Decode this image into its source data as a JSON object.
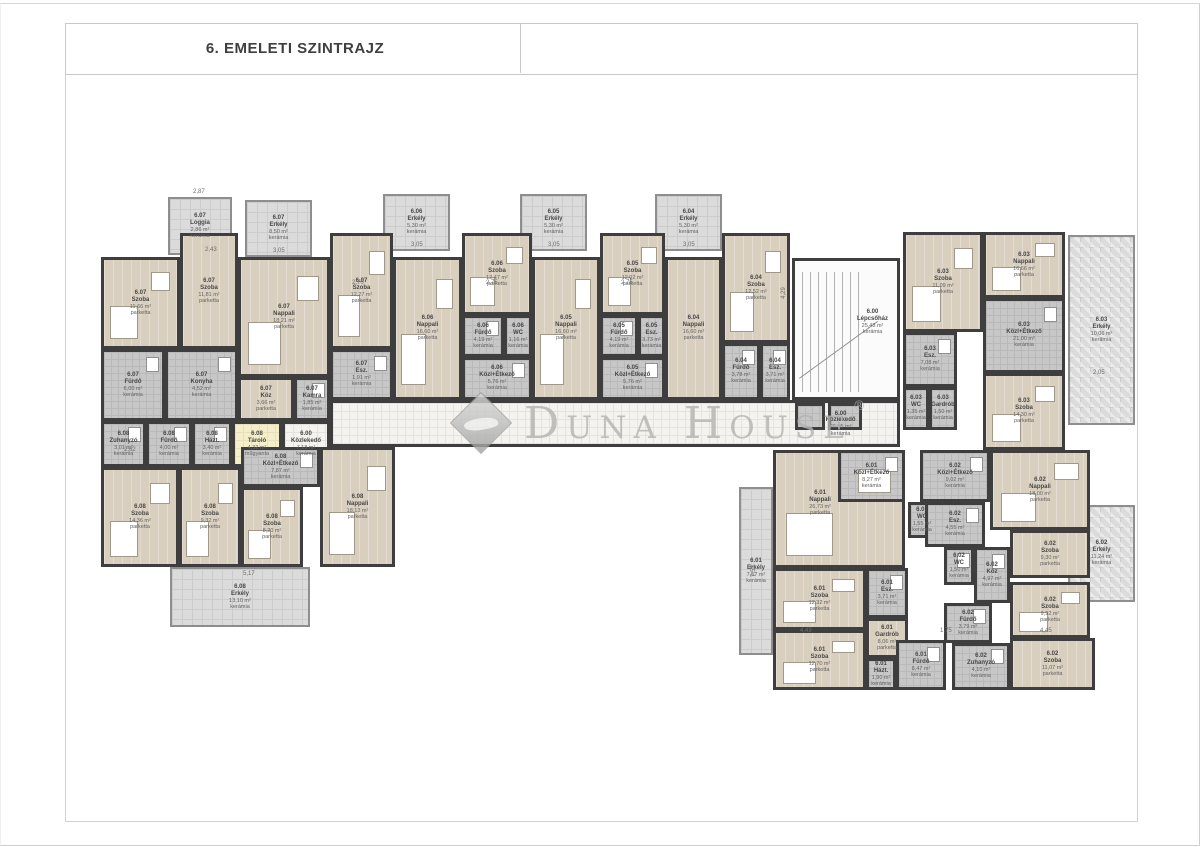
{
  "page": {
    "title": "6. EMELETI SZINTRAJZ"
  },
  "watermark": {
    "text": "Duna House",
    "reg": "®"
  },
  "colors": {
    "wall": "#3e3e3e",
    "parquet_room": "#d9cfbf",
    "ceramic_room": "#c7c7c7",
    "corridor": "#f4f3ef",
    "storage": "#f4eecb",
    "balcony": "#dbdbdb",
    "watermark_gray": "#b3b3b3"
  },
  "legend": {
    "room_types": [
      "parketta = parquet floor",
      "kerámia = ceramic tile",
      "műgyanta = resin floor"
    ],
    "floor_label": "6. emelet"
  },
  "plan": {
    "rooms": [
      {
        "u": "6.07",
        "n": "Loggia",
        "a": "2,86 m²",
        "f": "kerámia",
        "t": "balc",
        "x": 168,
        "y": 197,
        "w": 64,
        "h": 58
      },
      {
        "u": "6.07",
        "n": "Erkély",
        "a": "8,50 m²",
        "f": "kerámia",
        "t": "balc",
        "x": 245,
        "y": 200,
        "w": 67,
        "h": 57
      },
      {
        "u": "6.06",
        "n": "Erkély",
        "a": "5,30 m²",
        "f": "kerámia",
        "t": "balc",
        "x": 383,
        "y": 194,
        "w": 67,
        "h": 57
      },
      {
        "u": "6.05",
        "n": "Erkély",
        "a": "5,30 m²",
        "f": "kerámia",
        "t": "balc",
        "x": 520,
        "y": 194,
        "w": 67,
        "h": 57
      },
      {
        "u": "6.04",
        "n": "Erkély",
        "a": "5,30 m²",
        "f": "kerámia",
        "t": "balc",
        "x": 655,
        "y": 194,
        "w": 67,
        "h": 57
      },
      {
        "u": "6.03",
        "n": "Erkély",
        "a": "10,06 m²",
        "f": "kerámia",
        "t": "balch",
        "x": 1068,
        "y": 235,
        "w": 67,
        "h": 190
      },
      {
        "u": "6.02",
        "n": "Erkély",
        "a": "11,24 m²",
        "f": "kerámia",
        "t": "balch",
        "x": 1068,
        "y": 505,
        "w": 67,
        "h": 97
      },
      {
        "u": "6.01",
        "n": "Erkély",
        "a": "7,57 m²",
        "f": "kerámia",
        "t": "balc",
        "x": 739,
        "y": 487,
        "w": 34,
        "h": 168
      },
      {
        "u": "6.08",
        "n": "Erkély",
        "a": "13,10 m²",
        "f": "kerámia",
        "t": "balc",
        "x": 170,
        "y": 567,
        "w": 140,
        "h": 60
      },
      {
        "u": "6.07",
        "n": "Szoba",
        "a": "11,66 m²",
        "f": "parketta",
        "t": "park",
        "x": 101,
        "y": 257,
        "w": 79,
        "h": 92
      },
      {
        "u": "6.07",
        "n": "Fürdő",
        "a": "6,00 m²",
        "f": "kerámia",
        "t": "tile",
        "x": 101,
        "y": 349,
        "w": 64,
        "h": 72
      },
      {
        "u": "6.07",
        "n": "Szoba",
        "a": "11,81 m²",
        "f": "parketta",
        "t": "park",
        "x": 180,
        "y": 233,
        "w": 58,
        "h": 116
      },
      {
        "u": "6.07",
        "n": "Konyha",
        "a": "4,52 m²",
        "f": "kerámia",
        "t": "tile",
        "x": 165,
        "y": 349,
        "w": 73,
        "h": 72
      },
      {
        "u": "6.07",
        "n": "Nappali",
        "a": "18,21 m²",
        "f": "parketta",
        "t": "park",
        "x": 238,
        "y": 257,
        "w": 92,
        "h": 120
      },
      {
        "u": "6.07",
        "n": "Köz",
        "a": "3,66 m²",
        "f": "parketta",
        "t": "park",
        "x": 238,
        "y": 377,
        "w": 56,
        "h": 44
      },
      {
        "u": "6.07",
        "n": "Kamra",
        "a": "1,85 m²",
        "f": "kerámia",
        "t": "tile",
        "x": 294,
        "y": 377,
        "w": 36,
        "h": 44
      },
      {
        "u": "6.07",
        "n": "Szoba",
        "a": "12,27 m²",
        "f": "parketta",
        "t": "park",
        "x": 330,
        "y": 233,
        "w": 63,
        "h": 116
      },
      {
        "u": "6.07",
        "n": "Esz.",
        "a": "1,91 m²",
        "f": "kerámia",
        "t": "tile",
        "x": 330,
        "y": 349,
        "w": 63,
        "h": 51
      },
      {
        "u": "6.06",
        "n": "Nappali",
        "a": "16,60 m²",
        "f": "parketta",
        "t": "park",
        "x": 393,
        "y": 257,
        "w": 69,
        "h": 143
      },
      {
        "u": "6.06",
        "n": "Szoba",
        "a": "12,47 m²",
        "f": "parketta",
        "t": "park",
        "x": 462,
        "y": 233,
        "w": 70,
        "h": 82
      },
      {
        "u": "6.06",
        "n": "Fürdő",
        "a": "4,19 m²",
        "f": "kerámia",
        "t": "tile",
        "x": 462,
        "y": 315,
        "w": 42,
        "h": 42
      },
      {
        "u": "6.06",
        "n": "WC",
        "a": "1,16 m²",
        "f": "kerámia",
        "t": "tile",
        "x": 504,
        "y": 315,
        "w": 28,
        "h": 42
      },
      {
        "u": "6.06",
        "n": "Közl+Étkező",
        "a": "5,76 m²",
        "f": "kerámia",
        "t": "tile",
        "x": 462,
        "y": 357,
        "w": 70,
        "h": 43
      },
      {
        "u": "6.05",
        "n": "Nappali",
        "a": "16,60 m²",
        "f": "parketta",
        "t": "park",
        "x": 532,
        "y": 257,
        "w": 68,
        "h": 143
      },
      {
        "u": "6.05",
        "n": "Szoba",
        "a": "12,02 m²",
        "f": "parketta",
        "t": "park",
        "x": 600,
        "y": 233,
        "w": 65,
        "h": 82
      },
      {
        "u": "6.05",
        "n": "Fürdő",
        "a": "4,19 m²",
        "f": "kerámia",
        "t": "tile",
        "x": 600,
        "y": 315,
        "w": 38,
        "h": 42
      },
      {
        "u": "6.05",
        "n": "Esz.",
        "a": "3,73 m²",
        "f": "kerámia",
        "t": "tile",
        "x": 638,
        "y": 315,
        "w": 27,
        "h": 42
      },
      {
        "u": "6.05",
        "n": "Közl+Étkező",
        "a": "5,76 m²",
        "f": "kerámia",
        "t": "tile",
        "x": 600,
        "y": 357,
        "w": 65,
        "h": 43
      },
      {
        "u": "6.04",
        "n": "Nappali",
        "a": "16,60 m²",
        "f": "parketta",
        "t": "park",
        "x": 665,
        "y": 257,
        "w": 57,
        "h": 143
      },
      {
        "u": "6.04",
        "n": "Szoba",
        "a": "12,52 m²",
        "f": "parketta",
        "t": "park",
        "x": 722,
        "y": 233,
        "w": 68,
        "h": 110
      },
      {
        "u": "6.04",
        "n": "Fürdő",
        "a": "3,78 m²",
        "f": "kerámia",
        "t": "tile",
        "x": 722,
        "y": 343,
        "w": 38,
        "h": 57
      },
      {
        "u": "6.04",
        "n": "Esz.",
        "a": "3,71 m²",
        "f": "kerámia",
        "t": "tile",
        "x": 760,
        "y": 343,
        "w": 30,
        "h": 57
      },
      {
        "u": "6.00",
        "n": "Lépcsőház",
        "a": "25,43 m²",
        "f": "kerámia",
        "t": "stair",
        "x": 792,
        "y": 258,
        "w": 108,
        "h": 142,
        "cx": 76,
        "cy": 45
      },
      {
        "u": "6.00",
        "n": "Közlekedő",
        "a": "26,55 m²",
        "f": "kerámia",
        "t": "corr",
        "x": 330,
        "y": 400,
        "w": 570,
        "h": 47,
        "cx": 90,
        "cy": 50
      },
      {
        "t": "tile",
        "x": 795,
        "y": 403,
        "w": 30,
        "h": 27
      },
      {
        "t": "tile",
        "x": 828,
        "y": 403,
        "w": 34,
        "h": 27
      },
      {
        "u": "6.00",
        "n": "Közlekedő",
        "a": "7,18 m²",
        "f": "kerámia",
        "t": "corr",
        "x": 282,
        "y": 421,
        "w": 48,
        "h": 46
      },
      {
        "u": "6.08",
        "n": "Zuhanyzó",
        "a": "3,01 m²",
        "f": "kerámia",
        "t": "tile",
        "x": 101,
        "y": 421,
        "w": 45,
        "h": 46
      },
      {
        "u": "6.08",
        "n": "Fürdő",
        "a": "4,00 m²",
        "f": "kerámia",
        "t": "tile",
        "x": 146,
        "y": 421,
        "w": 46,
        "h": 46
      },
      {
        "u": "6.08",
        "n": "Házt.",
        "a": "3,40 m²",
        "f": "kerámia",
        "t": "tile",
        "x": 192,
        "y": 421,
        "w": 40,
        "h": 46
      },
      {
        "u": "6.08",
        "n": "Tároló",
        "a": "4,32 m²",
        "f": "műgyanta",
        "t": "stor",
        "x": 232,
        "y": 421,
        "w": 50,
        "h": 46
      },
      {
        "u": "6.08",
        "n": "Szoba",
        "a": "14,36 m²",
        "f": "parketta",
        "t": "park",
        "x": 101,
        "y": 467,
        "w": 78,
        "h": 100
      },
      {
        "u": "6.08",
        "n": "Szoba",
        "a": "9,32 m²",
        "f": "parketta",
        "t": "park",
        "x": 179,
        "y": 467,
        "w": 62,
        "h": 100
      },
      {
        "u": "6.08",
        "n": "Közl+Étkező",
        "a": "7,87 m²",
        "f": "kerámia",
        "t": "tile",
        "x": 241,
        "y": 447,
        "w": 79,
        "h": 40
      },
      {
        "u": "6.08",
        "n": "Szoba",
        "a": "8,20 m²",
        "f": "parketta",
        "t": "park",
        "x": 241,
        "y": 487,
        "w": 62,
        "h": 80
      },
      {
        "u": "6.08",
        "n": "Nappali",
        "a": "18,13 m²",
        "f": "parketta",
        "t": "park",
        "x": 320,
        "y": 447,
        "w": 75,
        "h": 120
      },
      {
        "u": "6.03",
        "n": "Szoba",
        "a": "11,09 m²",
        "f": "parketta",
        "t": "park",
        "x": 903,
        "y": 232,
        "w": 80,
        "h": 100
      },
      {
        "u": "6.03",
        "n": "Nappali",
        "a": "16,66 m²",
        "f": "parketta",
        "t": "park",
        "x": 983,
        "y": 232,
        "w": 82,
        "h": 66
      },
      {
        "u": "6.03",
        "n": "Közl+Étkező",
        "a": "21,00 m²",
        "f": "kerámia",
        "t": "tile",
        "x": 983,
        "y": 298,
        "w": 82,
        "h": 75
      },
      {
        "u": "6.03",
        "n": "Esz.",
        "a": "7,08 m²",
        "f": "kerámia",
        "t": "tile",
        "x": 903,
        "y": 332,
        "w": 54,
        "h": 55
      },
      {
        "u": "6.03",
        "n": "WC",
        "a": "1,35 m²",
        "f": "kerámia",
        "t": "tile",
        "x": 903,
        "y": 387,
        "w": 26,
        "h": 43
      },
      {
        "u": "6.03",
        "n": "Gardrób",
        "a": "1,50 m²",
        "f": "kerámia",
        "t": "tile",
        "x": 929,
        "y": 387,
        "w": 28,
        "h": 43
      },
      {
        "u": "6.03",
        "n": "Szoba",
        "a": "14,30 m²",
        "f": "parketta",
        "t": "park",
        "x": 983,
        "y": 373,
        "w": 82,
        "h": 77
      },
      {
        "u": "6.01",
        "n": "Nappali",
        "a": "26,73 m²",
        "f": "parketta",
        "t": "park",
        "x": 773,
        "y": 450,
        "w": 132,
        "h": 118,
        "cx": 35,
        "cy": 45
      },
      {
        "u": "6.01",
        "n": "Közl+Étkező",
        "a": "8,27 m²",
        "f": "kerámia",
        "t": "tile",
        "x": 838,
        "y": 450,
        "w": 67,
        "h": 52
      },
      {
        "u": "6.01",
        "n": "Esz.",
        "a": "3,71 m²",
        "f": "kerámia",
        "t": "tile",
        "x": 866,
        "y": 568,
        "w": 42,
        "h": 50
      },
      {
        "u": "6.01",
        "n": "Szoba",
        "a": "12,32 m²",
        "f": "parketta",
        "t": "park",
        "x": 773,
        "y": 568,
        "w": 93,
        "h": 62
      },
      {
        "u": "6.01",
        "n": "Szoba",
        "a": "12,70 m²",
        "f": "parketta",
        "t": "park",
        "x": 773,
        "y": 630,
        "w": 93,
        "h": 60
      },
      {
        "u": "6.01",
        "n": "Gardrób",
        "a": "8,06 m²",
        "f": "parketta",
        "t": "park",
        "x": 866,
        "y": 618,
        "w": 42,
        "h": 40
      },
      {
        "u": "6.01",
        "n": "Házt.",
        "a": "1,90 m²",
        "f": "kerámia",
        "t": "tile",
        "x": 866,
        "y": 658,
        "w": 30,
        "h": 32
      },
      {
        "u": "6.01",
        "n": "Fürdő",
        "a": "8,47 m²",
        "f": "kerámia",
        "t": "tile",
        "x": 896,
        "y": 640,
        "w": 50,
        "h": 50
      },
      {
        "u": "6.01",
        "n": "WC",
        "a": "1,55 m²",
        "f": "kerámia",
        "t": "tile",
        "x": 908,
        "y": 502,
        "w": 28,
        "h": 36
      },
      {
        "u": "6.02",
        "n": "Közl+Étkező",
        "a": "9,02 m²",
        "f": "kerámia",
        "t": "tile",
        "x": 920,
        "y": 450,
        "w": 70,
        "h": 52
      },
      {
        "u": "6.02",
        "n": "Esz.",
        "a": "4,55 m²",
        "f": "kerámia",
        "t": "tile",
        "x": 925,
        "y": 502,
        "w": 60,
        "h": 45
      },
      {
        "u": "6.02",
        "n": "WC",
        "a": "1,50 m²",
        "f": "kerámia",
        "t": "tile",
        "x": 944,
        "y": 547,
        "w": 30,
        "h": 38
      },
      {
        "u": "6.02",
        "n": "Nappali",
        "a": "18,00 m²",
        "f": "parketta",
        "t": "park",
        "x": 990,
        "y": 450,
        "w": 100,
        "h": 80
      },
      {
        "u": "6.02",
        "n": "Köz",
        "a": "4,97 m²",
        "f": "kerámia",
        "t": "tile",
        "x": 974,
        "y": 547,
        "w": 36,
        "h": 56
      },
      {
        "u": "6.02",
        "n": "Szoba",
        "a": "9,30 m²",
        "f": "parketta",
        "t": "park",
        "x": 1010,
        "y": 530,
        "w": 80,
        "h": 48
      },
      {
        "u": "6.02",
        "n": "Szoba",
        "a": "9,92 m²",
        "f": "parketta",
        "t": "park",
        "x": 1010,
        "y": 582,
        "w": 80,
        "h": 56
      },
      {
        "u": "6.02",
        "n": "Fürdő",
        "a": "3,79 m²",
        "f": "kerámia",
        "t": "tile",
        "x": 944,
        "y": 603,
        "w": 48,
        "h": 40
      },
      {
        "u": "6.02",
        "n": "Zuhanyzó",
        "a": "4,10 m²",
        "f": "kerámia",
        "t": "tile",
        "x": 952,
        "y": 643,
        "w": 58,
        "h": 47
      },
      {
        "u": "6.02",
        "n": "Szoba",
        "a": "11,07 m²",
        "f": "parketta",
        "t": "park",
        "x": 1010,
        "y": 638,
        "w": 85,
        "h": 52
      }
    ],
    "dims": [
      {
        "t": "2,87",
        "x": 193,
        "y": 189
      },
      {
        "t": "2,43",
        "x": 205,
        "y": 247
      },
      {
        "t": "3,05",
        "x": 273,
        "y": 248
      },
      {
        "t": "3,05",
        "x": 411,
        "y": 242
      },
      {
        "t": "3,05",
        "x": 548,
        "y": 242
      },
      {
        "t": "3,05",
        "x": 683,
        "y": 242
      },
      {
        "t": "2,70",
        "x": 352,
        "y": 280
      },
      {
        "t": "2,75",
        "x": 486,
        "y": 280
      },
      {
        "t": "2,75",
        "x": 621,
        "y": 280
      },
      {
        "t": "2,62",
        "x": 124,
        "y": 447
      },
      {
        "t": "5,17",
        "x": 243,
        "y": 571
      },
      {
        "t": "2,05",
        "x": 1093,
        "y": 370
      },
      {
        "t": "4,45",
        "x": 1040,
        "y": 628
      },
      {
        "t": "4,43",
        "x": 800,
        "y": 628
      },
      {
        "t": "1,75",
        "x": 940,
        "y": 628
      },
      {
        "t": "7,57",
        "x": 748,
        "y": 568,
        "r": 1
      },
      {
        "t": "4,29",
        "x": 778,
        "y": 290,
        "r": 1
      }
    ]
  }
}
